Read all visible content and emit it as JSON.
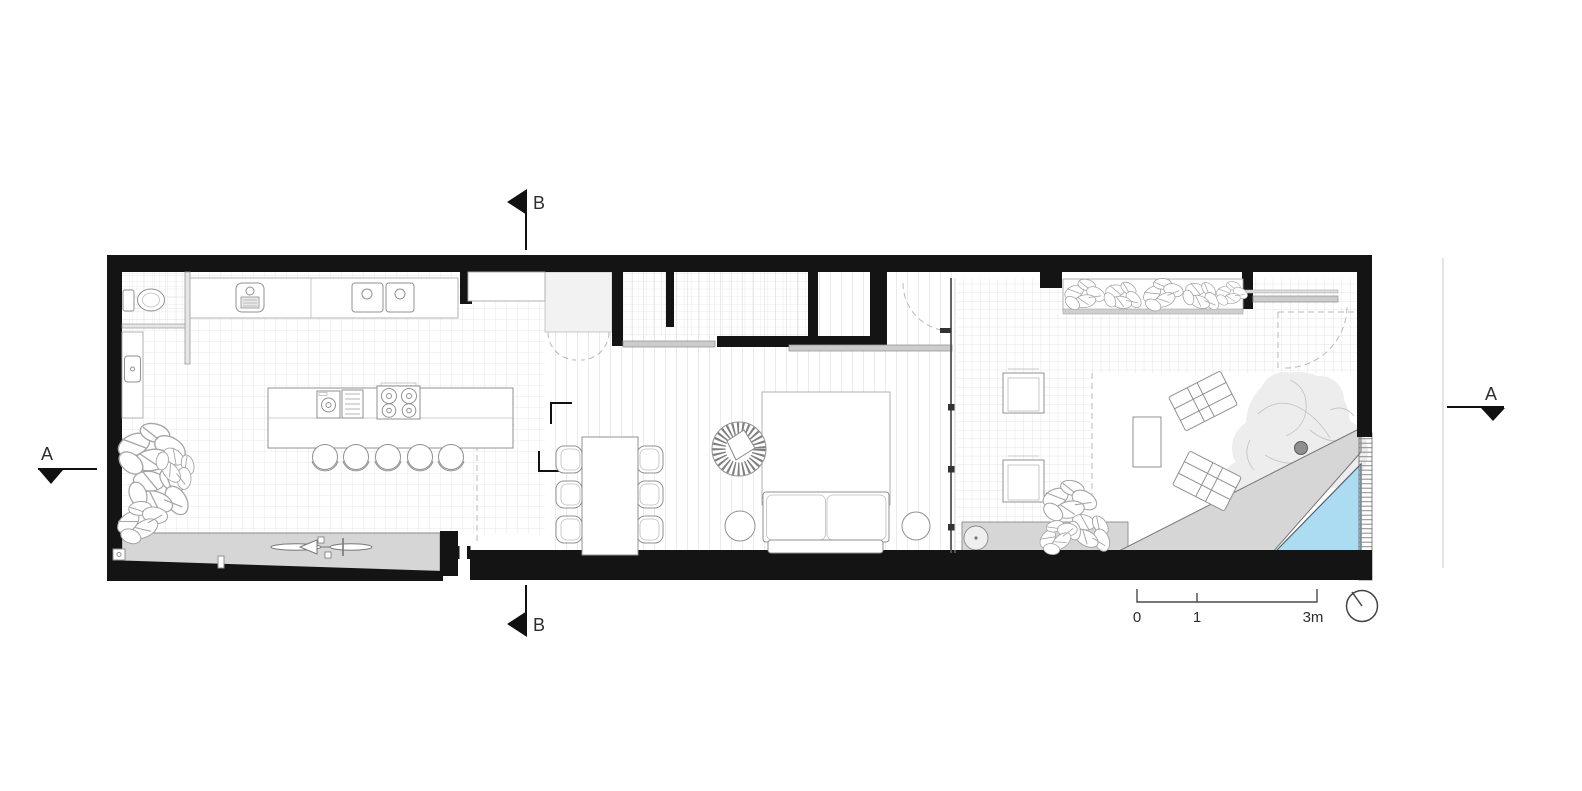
{
  "section_markers": {
    "top": "B",
    "bottom": "B",
    "left": "A",
    "right": "A"
  },
  "scale_bar": {
    "tick_start": "0",
    "tick_mid": "1",
    "tick_end": "3m"
  },
  "icons": {
    "north": "north-indicator-circle"
  },
  "colors": {
    "wall": "#141414",
    "pool": "#abdcf2",
    "paving": "#d6d6d6",
    "paving_light": "#ededed",
    "glass_line": "#555555",
    "grid_line": "#e0e0e0",
    "marker": "#111111"
  }
}
